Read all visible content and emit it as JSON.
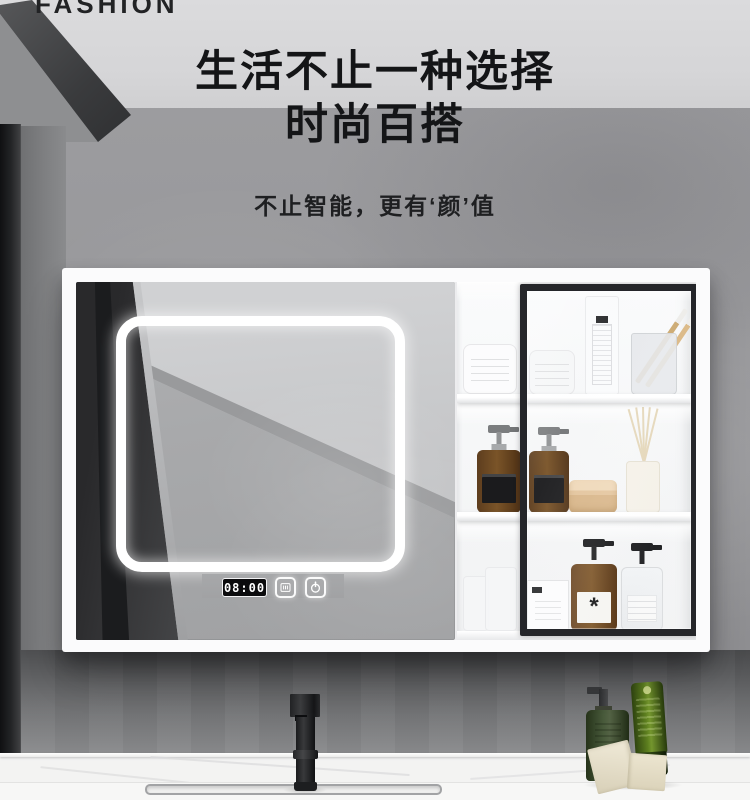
{
  "brand": {
    "watermark": "FASHION"
  },
  "hero": {
    "title_line1": "生活不止一种选择",
    "title_line2": "时尚百搭",
    "subtitle": "不止智能，更有‘颜’值"
  },
  "mirror": {
    "clock_time": "08:00",
    "controls": [
      {
        "name": "defog",
        "icon": "defog-icon"
      },
      {
        "name": "power",
        "icon": "power-icon"
      }
    ]
  },
  "products": {
    "amber_label_mark": "*"
  },
  "colors": {
    "ceiling": "#d7d7d9",
    "wall": "#97979a",
    "under_cabinet_wall": "#4c4d4f",
    "cabinet_white": "#fbfbfc",
    "door_frame_black": "#25262a",
    "led_white": "#ffffff",
    "amber_bottle": "#6e4a24",
    "green_bottle": "#3b4d2b",
    "green_tube": "#5d7f1f",
    "counter_white": "#f3f3f2"
  }
}
